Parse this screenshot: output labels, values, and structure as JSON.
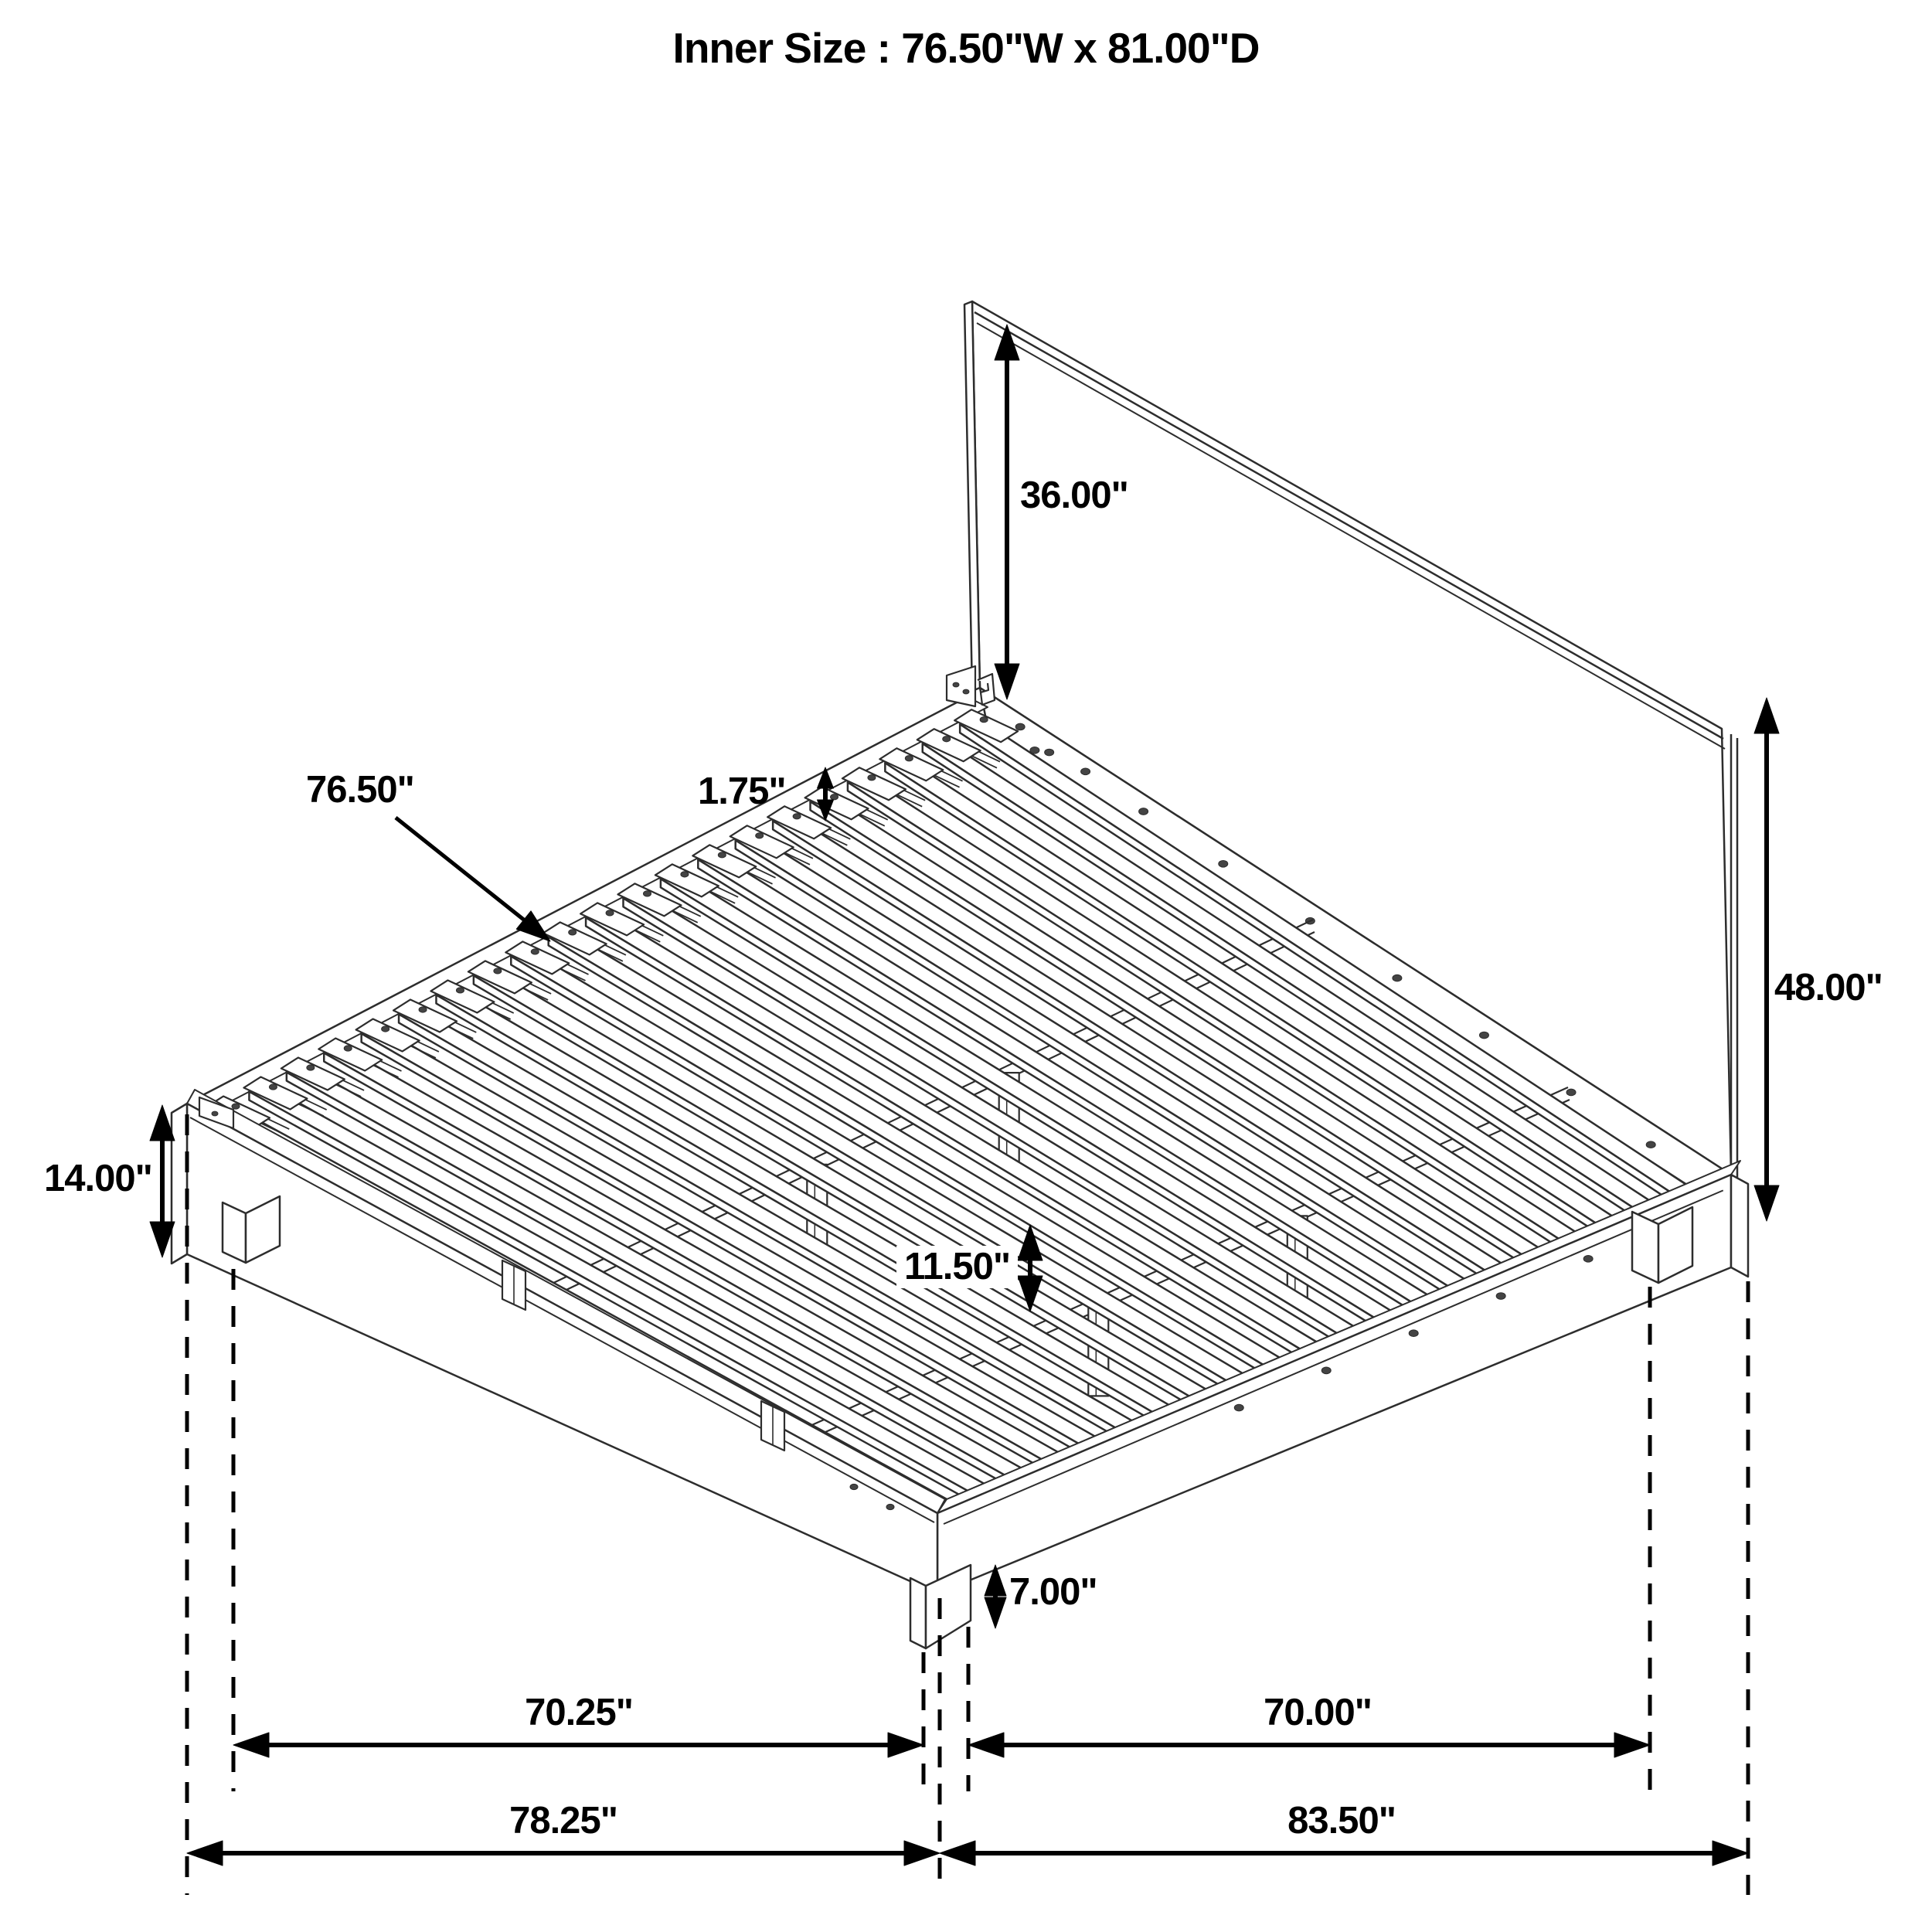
{
  "title": "Inner Size : 76.50\"W x 81.00\"D",
  "diagram_subject": "platform-bed-frame-isometric-dimension-drawing",
  "dimensions": {
    "headboard_above_deck": "36.00\"",
    "headboard_total_height": "48.00\"",
    "slat_length_width": "76.50\"",
    "slat_thickness": "1.75\"",
    "side_rail_height": "14.00\"",
    "under_bed_clearance": "11.50\"",
    "leg_height": "7.00\"",
    "front_leg_span": "70.25\"",
    "right_leg_span": "70.00\"",
    "front_overall_depth": "78.25\"",
    "right_overall_length": "83.50\""
  }
}
